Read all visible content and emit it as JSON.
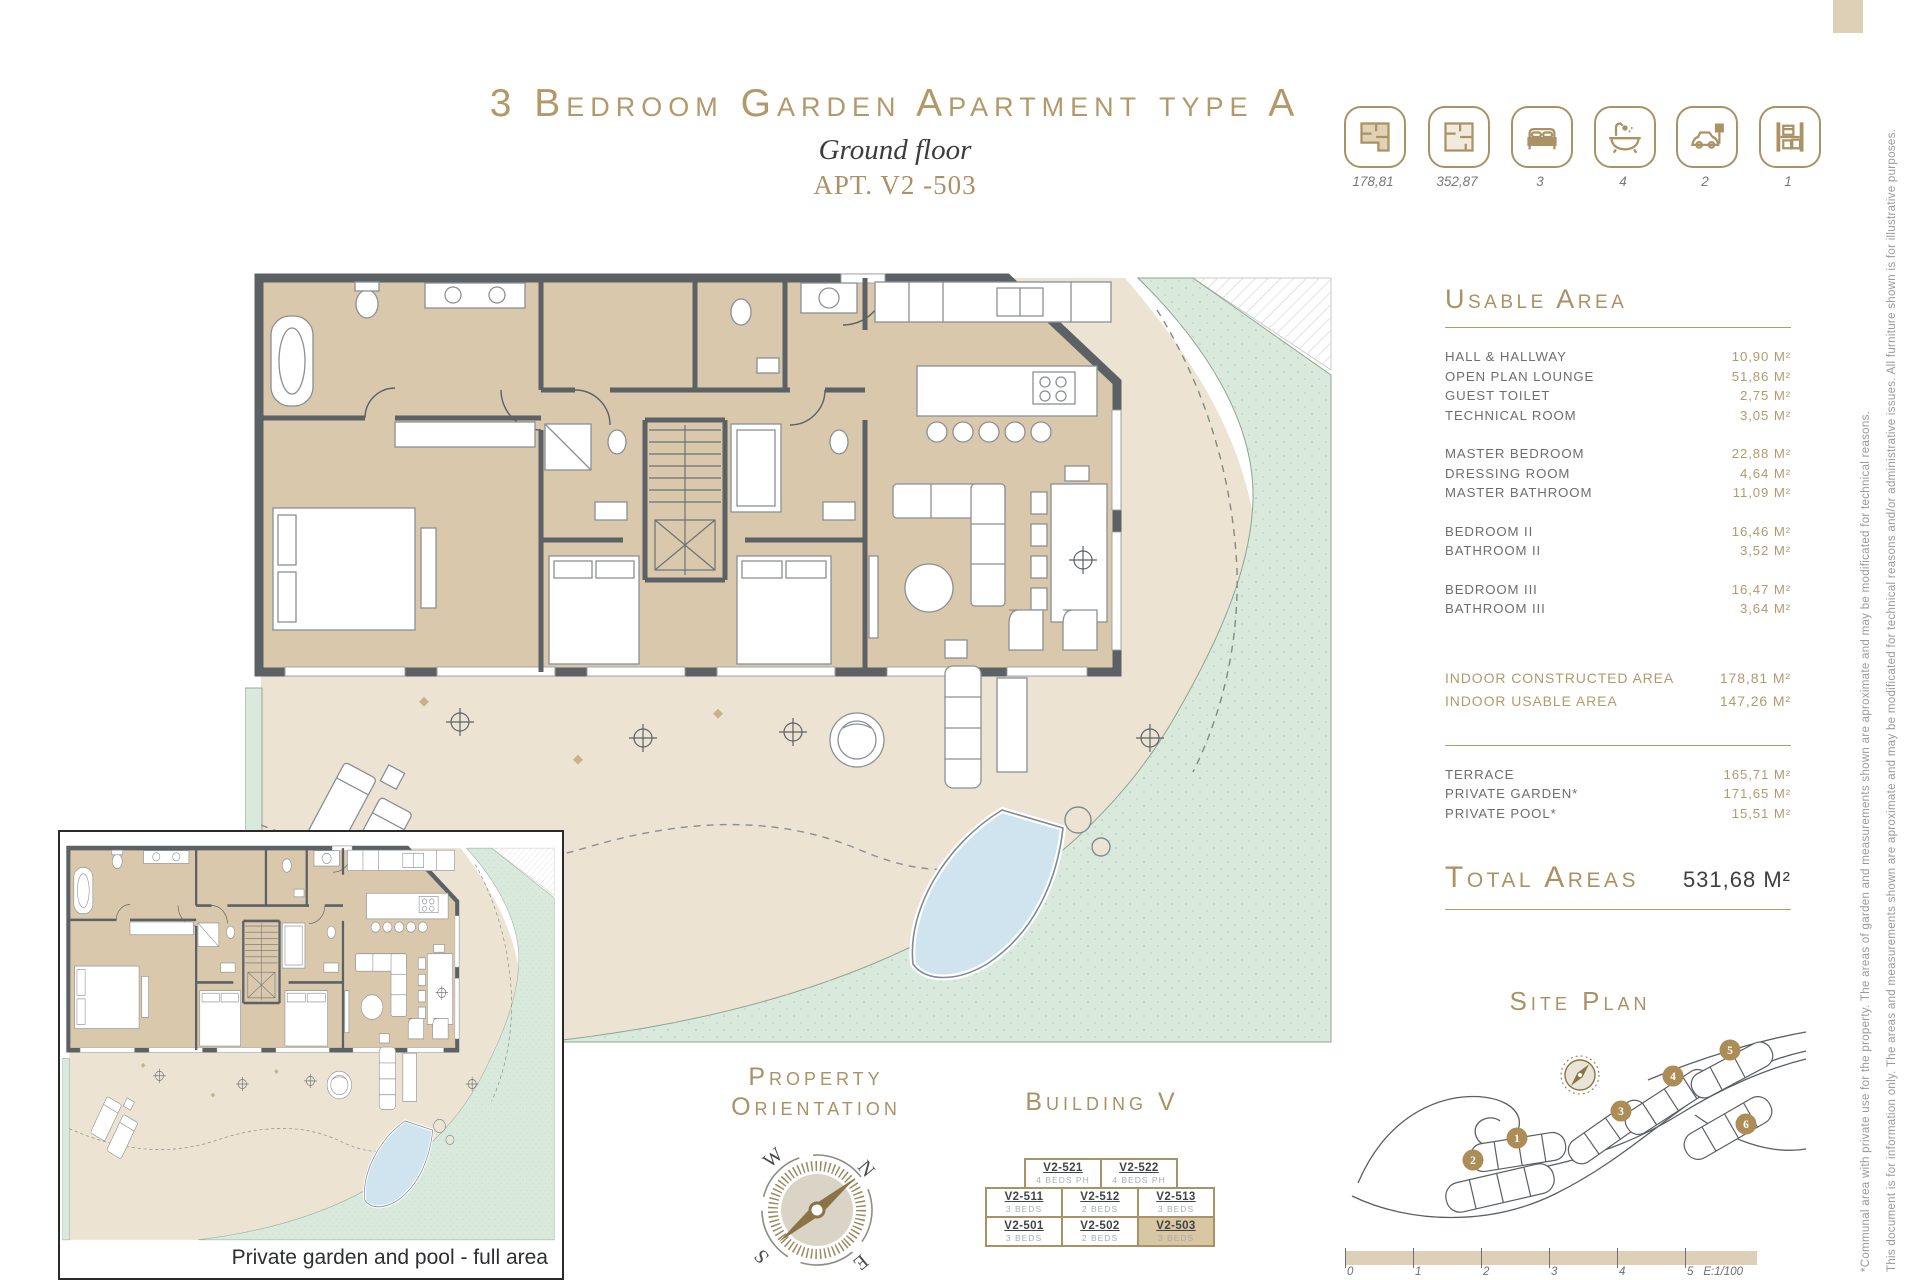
{
  "title": {
    "main": "3 Bedroom Garden Apartment type A",
    "floor": "Ground floor",
    "apt": "APT. V2 -503"
  },
  "icons": {
    "items": [
      {
        "name": "constructed-plan-icon",
        "value": "178,81"
      },
      {
        "name": "total-plan-icon",
        "value": "352,87"
      },
      {
        "name": "bed-icon",
        "value": "3"
      },
      {
        "name": "bath-icon",
        "value": "4"
      },
      {
        "name": "parking-icon",
        "value": "2"
      },
      {
        "name": "storage-icon",
        "value": "1"
      }
    ]
  },
  "usable": {
    "heading": "Usable Area",
    "g1": [
      {
        "label": "HALL & HALLWAY",
        "value": "10,90 M²"
      },
      {
        "label": "OPEN PLAN LOUNGE",
        "value": "51,86 M²"
      },
      {
        "label": "GUEST TOILET",
        "value": "2,75 M²"
      },
      {
        "label": "TECHNICAL ROOM",
        "value": "3,05 M²"
      }
    ],
    "g2": [
      {
        "label": "MASTER BEDROOM",
        "value": "22,88 M²"
      },
      {
        "label": "DRESSING ROOM",
        "value": "4,64 M²"
      },
      {
        "label": "MASTER BATHROOM",
        "value": "11,09 M²"
      }
    ],
    "g3": [
      {
        "label": "BEDROOM II",
        "value": "16,46 M²"
      },
      {
        "label": "BATHROOM II",
        "value": "3,52 M²"
      }
    ],
    "g4": [
      {
        "label": "BEDROOM III",
        "value": "16,47 M²"
      },
      {
        "label": "BATHROOM III",
        "value": "3,64 M²"
      }
    ]
  },
  "indoor": [
    {
      "label": "INDOOR CONSTRUCTED AREA",
      "value": "178,81 M²"
    },
    {
      "label": "INDOOR USABLE AREA",
      "value": "147,26 M²"
    }
  ],
  "outdoor": [
    {
      "label": "TERRACE",
      "value": "165,71 M²"
    },
    {
      "label": "PRIVATE GARDEN*",
      "value": "171,65 M²"
    },
    {
      "label": "PRIVATE POOL*",
      "value": "15,51 M²"
    }
  ],
  "total": {
    "label": "Total Areas",
    "value": "531,68 M²"
  },
  "site": {
    "heading": "Site Plan",
    "markers": [
      "1",
      "2",
      "3",
      "4",
      "5",
      "6"
    ]
  },
  "orientation": {
    "l1": "Property",
    "l2": "Orientation",
    "n": "N",
    "e": "E",
    "s": "S",
    "w": "W"
  },
  "building": {
    "heading": "Building V",
    "r1": [
      {
        "unit": "V2-521",
        "beds": "4 BEDS PH"
      },
      {
        "unit": "V2-522",
        "beds": "4 BEDS PH"
      }
    ],
    "r2": [
      {
        "unit": "V2-511",
        "beds": "3 BEDS"
      },
      {
        "unit": "V2-512",
        "beds": "2 BEDS"
      },
      {
        "unit": "V2-513",
        "beds": "3 BEDS"
      }
    ],
    "r3": [
      {
        "unit": "V2-501",
        "beds": "3 BEDS"
      },
      {
        "unit": "V2-502",
        "beds": "2 BEDS"
      },
      {
        "unit": "V2-503",
        "beds": "3 BEDS"
      }
    ]
  },
  "inset": {
    "caption": "Private garden and pool - full area"
  },
  "scalebar": {
    "ticks": [
      "0",
      "1",
      "2",
      "3",
      "4",
      "5"
    ],
    "scale": "E:1/100"
  },
  "disclaimer": {
    "l1": "This document is for information only. The areas and measurements shown are aproximate and may be modificated for technical reasons and/or administrative issues. All furniture shown is for illustrative purposes.",
    "l2": "*Communal area with private use for the property. The areas of garden and measurements shown are aproximate and may be modificated for technical reasons."
  },
  "colors": {
    "gold": "#ab9164",
    "wall": "#5c6165",
    "room": "#d9c8ab",
    "terrace": "#ece3d3",
    "garden": "#d9e9dc",
    "pool": "#cfe4ef",
    "highlight_cell": "#d9c6a2"
  }
}
